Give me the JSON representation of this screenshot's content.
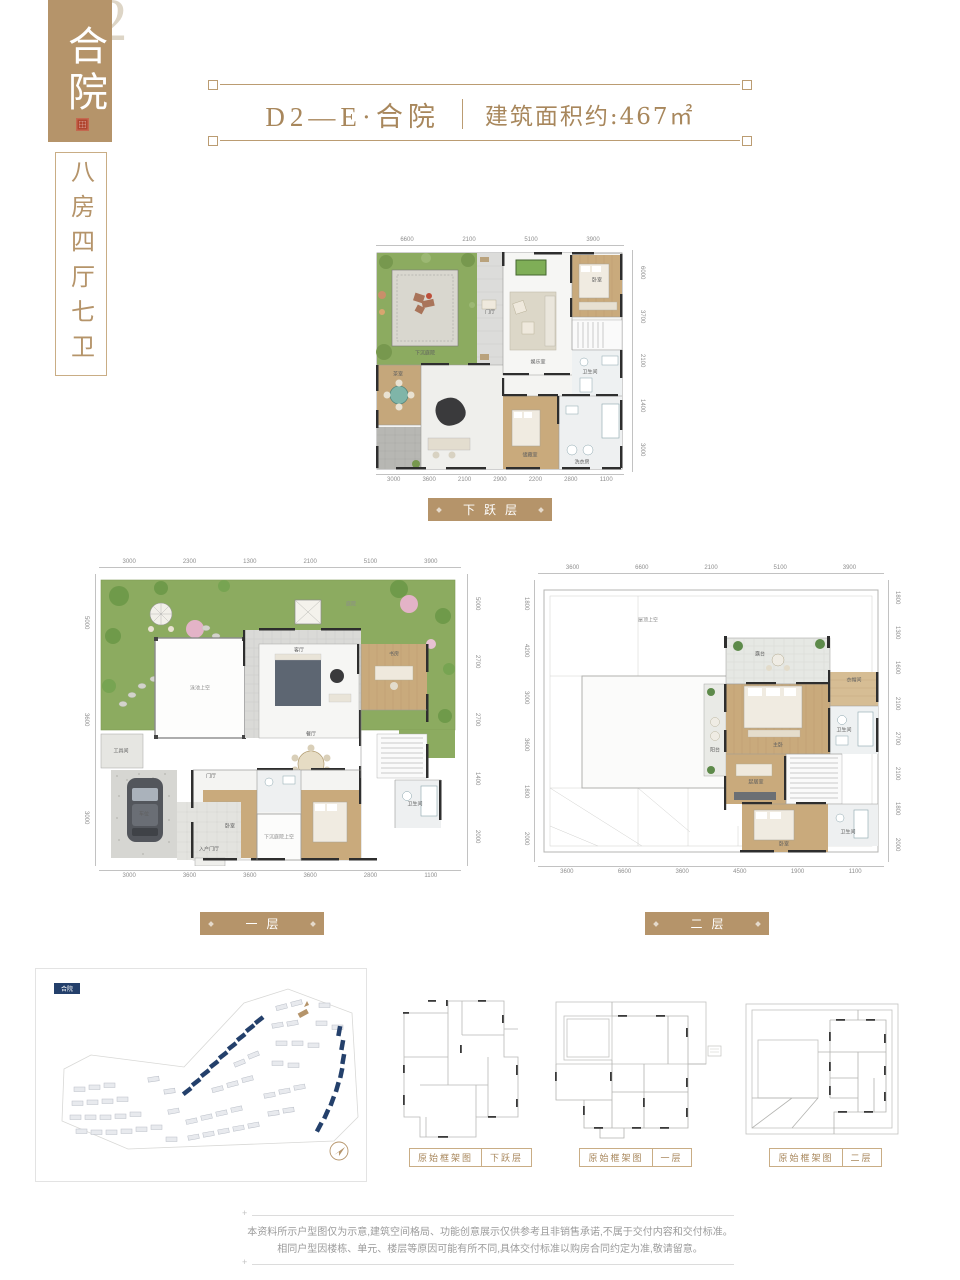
{
  "brand": {
    "watermark": "D2",
    "name_vertical": "合院",
    "spec_vertical": "八房四厅七卫"
  },
  "header": {
    "unit": "D2—E·合院",
    "area": "建筑面积约:467㎡"
  },
  "plans": {
    "lower": {
      "banner": "下跃层",
      "dims_top": [
        "6600",
        "2100",
        "5100",
        "3900"
      ],
      "dims_right": [
        "6000",
        "3700",
        "2100",
        "1400",
        "3000"
      ],
      "dims_bottom": [
        "3000",
        "3600",
        "2100",
        "2900",
        "2200",
        "2800",
        "1100"
      ],
      "rooms": [
        "下沉庭院",
        "门厅",
        "娱乐室",
        "卧室",
        "茶室",
        "卫生间",
        "储藏室",
        "洗衣房"
      ]
    },
    "first": {
      "banner": "一层",
      "dims_top": [
        "3000",
        "2300",
        "1300",
        "2100",
        "5100",
        "3900"
      ],
      "dims_left": [
        "5000",
        "3600",
        "3000"
      ],
      "dims_right": [
        "5000",
        "2700",
        "2700",
        "1400",
        "2000"
      ],
      "dims_bottom": [
        "3000",
        "3600",
        "3600",
        "3600",
        "2800",
        "1100"
      ],
      "rooms": [
        "庭院",
        "泳池上空",
        "客厅",
        "餐厅",
        "书房",
        "门厅",
        "车位",
        "入户门厅",
        "卧室",
        "卫生间",
        "下沉庭院上空",
        "工具间"
      ]
    },
    "second": {
      "banner": "二层",
      "dims_top": [
        "3600",
        "6600",
        "2100",
        "5100",
        "3900"
      ],
      "dims_left": [
        "1800",
        "4200",
        "3000",
        "3600",
        "1800",
        "2000"
      ],
      "dims_right": [
        "1800",
        "1300",
        "1600",
        "2100",
        "2700",
        "2100",
        "1800",
        "2000"
      ],
      "dims_bottom": [
        "3600",
        "6600",
        "3600",
        "4500",
        "1900",
        "1100"
      ],
      "rooms": [
        "屋顶上空",
        "露台",
        "主卧",
        "衣帽间",
        "卫生间",
        "起居室",
        "卧室",
        "卫生间",
        "阳台"
      ]
    }
  },
  "sitemap": {
    "legend": "合院"
  },
  "frameworks": [
    {
      "title": "原始框架图",
      "floor": "下跃层"
    },
    {
      "title": "原始框架图",
      "floor": "一层"
    },
    {
      "title": "原始框架图",
      "floor": "二层"
    }
  ],
  "disclaimer": [
    "本资料所示户型图仅为示意,建筑空间格局、功能创意展示仅供参考且非销售承诺,不属于交付内容和交付标准。",
    "相同户型因楼栋、单元、楼层等原因可能有所不同,具体交付标准以购房合同约定为准,敬请留意。"
  ],
  "colors": {
    "gold": "#b5946a",
    "navy": "#24406b",
    "seal_red": "#b0452e"
  }
}
